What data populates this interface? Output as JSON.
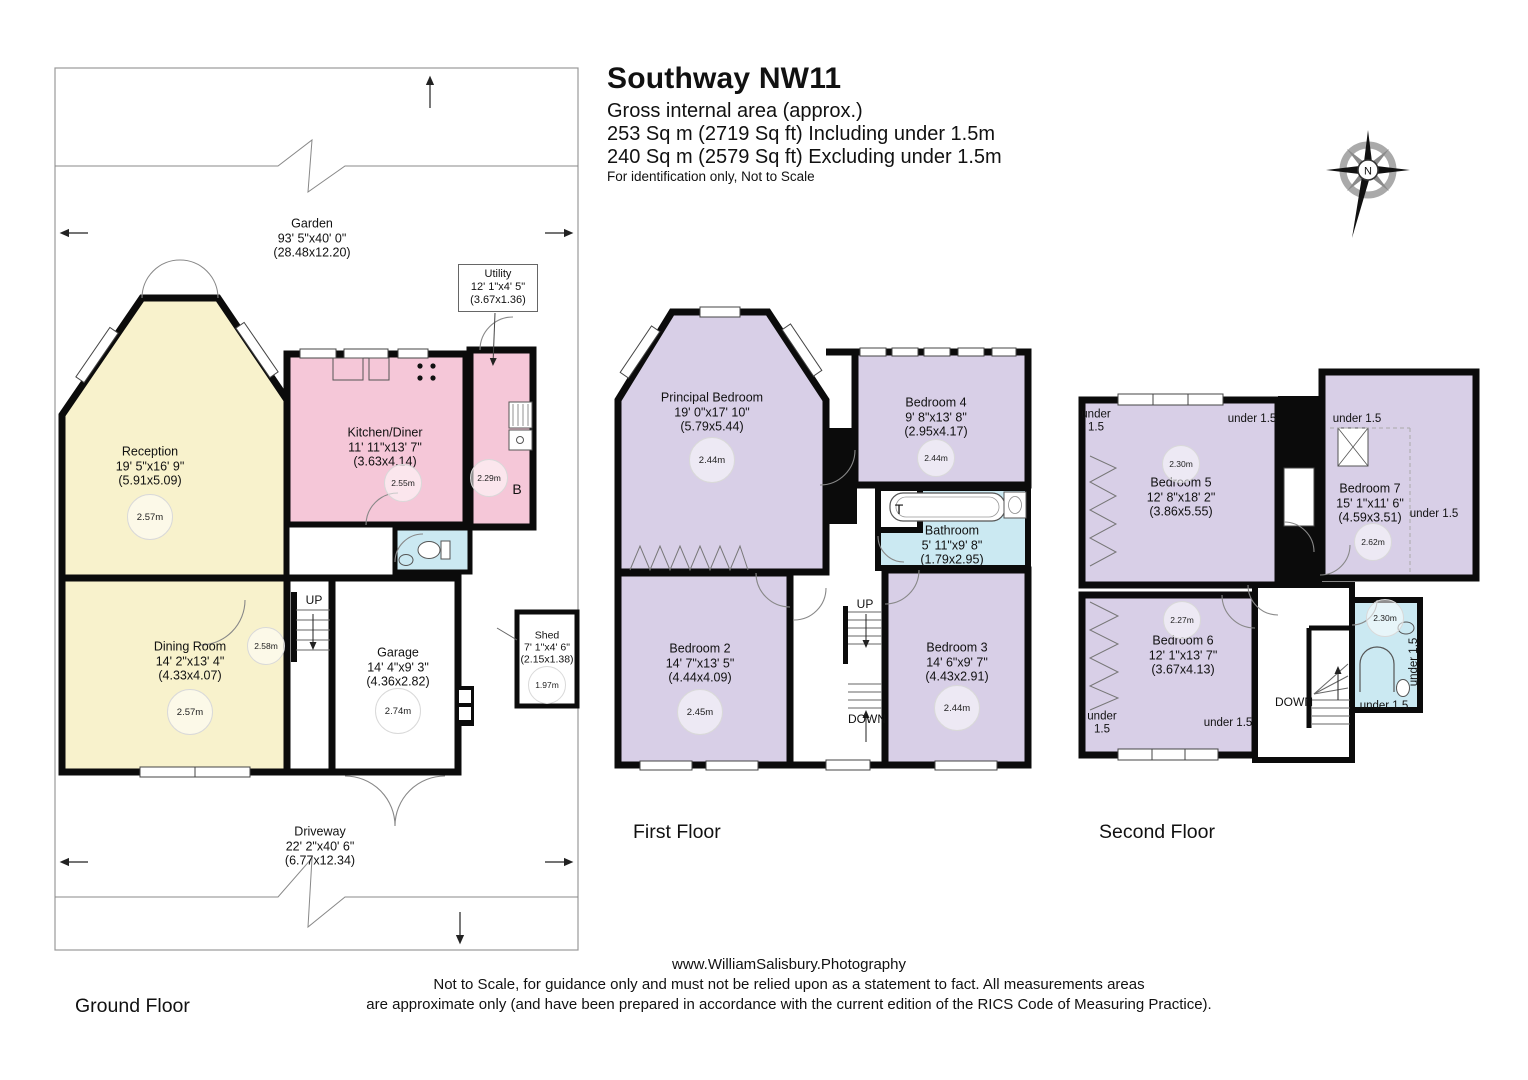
{
  "title": {
    "address": "Southway NW11",
    "gross_line": "Gross internal area (approx.)",
    "including_line": "253 Sq m (2719 Sq ft) Including under 1.5m",
    "excluding_line": "240 Sq m (2579 Sq ft) Excluding under 1.5m",
    "identification_line": "For identification only, Not to Scale"
  },
  "compass": {
    "north_label": "N"
  },
  "colors": {
    "room_cream": "#f8f2cc",
    "room_pink": "#f5c7d8",
    "room_lavender": "#d8cfe7",
    "room_blue": "#cbe9f2",
    "wall_black": "#0b0b0b"
  },
  "floors": {
    "ground": {
      "label": "Ground Floor",
      "garden": {
        "name": "Garden",
        "imperial": "93' 5\"x40' 0\"",
        "metric": "(28.48x12.20)"
      },
      "driveway": {
        "name": "Driveway",
        "imperial": "22' 2\"x40' 6\"",
        "metric": "(6.77x12.34)"
      },
      "reception": {
        "name": "Reception",
        "imperial": "19' 5\"x16' 9\"",
        "metric": "(5.91x5.09)",
        "ceiling_height": "2.57m"
      },
      "kitchen_diner": {
        "name": "Kitchen/Diner",
        "imperial": "11' 11\"x13' 7\"",
        "metric": "(3.63x4.14)",
        "ceiling_height": "2.55m"
      },
      "utility": {
        "name": "Utility",
        "imperial": "12' 1\"x4' 5\"",
        "metric": "(3.67x1.36)",
        "ceiling_height": "2.29m",
        "boiler_label": "B"
      },
      "dining_room": {
        "name": "Dining Room",
        "imperial": "14' 2\"x13' 4\"",
        "metric": "(4.33x4.07)",
        "ceiling_height": "2.57m"
      },
      "garage": {
        "name": "Garage",
        "imperial": "14' 4\"x9' 3\"",
        "metric": "(4.36x2.82)",
        "ceiling_height": "2.74m"
      },
      "shed": {
        "name": "Shed",
        "imperial": "7' 1\"x4' 6\"",
        "metric": "(2.15x1.38)",
        "ceiling_height": "1.97m"
      },
      "hall_ceiling_height": "2.58m",
      "stairs_up": "UP"
    },
    "first": {
      "label": "First Floor",
      "principal_bedroom": {
        "name": "Principal Bedroom",
        "imperial": "19' 0\"x17' 10\"",
        "metric": "(5.79x5.44)",
        "ceiling_height": "2.44m"
      },
      "bedroom4": {
        "name": "Bedroom 4",
        "imperial": "9' 8\"x13' 8\"",
        "metric": "(2.95x4.17)",
        "ceiling_height": "2.44m"
      },
      "bathroom": {
        "name": "Bathroom",
        "imperial": "5' 11\"x9' 8\"",
        "metric": "(1.79x2.95)"
      },
      "toilet_label": "T",
      "bedroom2": {
        "name": "Bedroom 2",
        "imperial": "14' 7\"x13' 5\"",
        "metric": "(4.44x4.09)",
        "ceiling_height": "2.45m"
      },
      "bedroom3": {
        "name": "Bedroom 3",
        "imperial": "14' 6\"x9' 7\"",
        "metric": "(4.43x2.91)",
        "ceiling_height": "2.44m"
      },
      "stairs_up": "UP",
      "stairs_down": "DOWN"
    },
    "second": {
      "label": "Second Floor",
      "bedroom5": {
        "name": "Bedroom 5",
        "imperial": "12' 8\"x18' 2\"",
        "metric": "(3.86x5.55)",
        "ceiling_height": "2.30m"
      },
      "bedroom6": {
        "name": "Bedroom 6",
        "imperial": "12' 1\"x13' 7\"",
        "metric": "(3.67x4.13)",
        "ceiling_height": "2.27m"
      },
      "bedroom7": {
        "name": "Bedroom 7",
        "imperial": "15' 1\"x11' 6\"",
        "metric": "(4.59x3.51)",
        "ceiling_height": "2.62m"
      },
      "bathroom_ceiling_height": "2.30m",
      "under_eaves": "under 1.5",
      "under_eaves_stacked": "under\n1.5",
      "stairs_down": "DOWN"
    }
  },
  "footer": {
    "website": "www.WilliamSalisbury.Photography",
    "disclaimer_line1": "Not to Scale, for guidance only and must not be relied upon as a statement to fact. All measurements areas",
    "disclaimer_line2": "are approximate only (and have been prepared in accordance with the current edition of the RICS Code of Measuring Practice)."
  }
}
